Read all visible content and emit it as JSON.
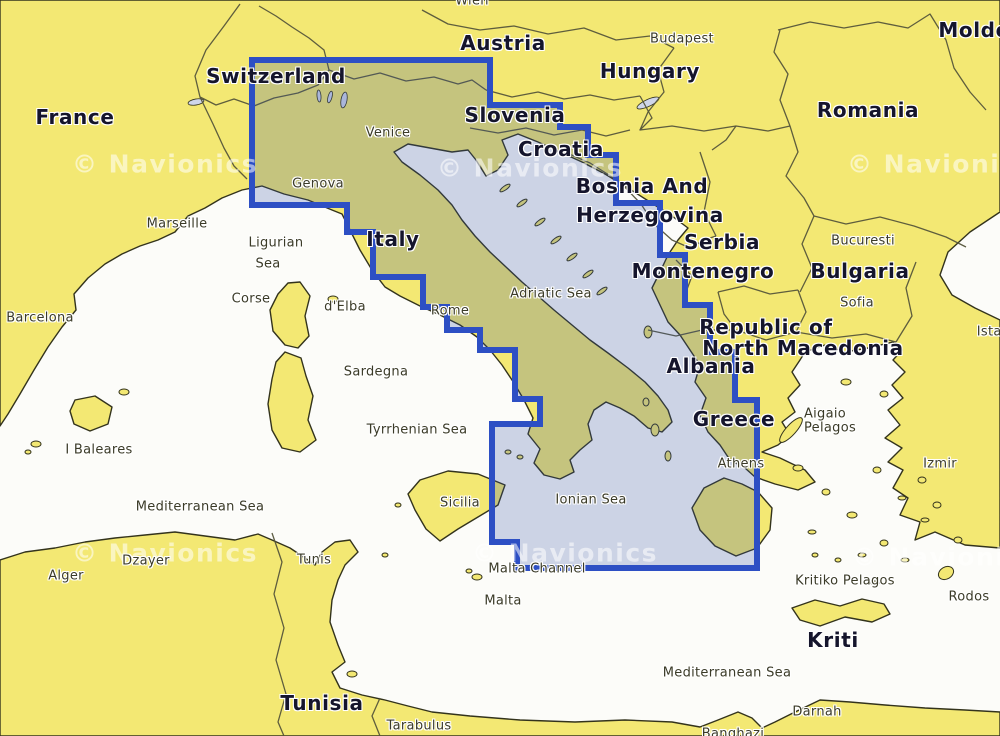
{
  "map": {
    "colors": {
      "sea": "#fcfcf9",
      "land": "#f3e873",
      "coastline": "#33331c",
      "border_line": "#55553a",
      "lake": "#cfd6ea",
      "coverage_fill": "rgba(47,76,164,0.23)",
      "coverage_border": "#2d4fc4",
      "label_large": "#15152c",
      "label_small": "#3b3b28",
      "watermark": "rgba(255,255,255,0.55)"
    },
    "coverage": {
      "points": [
        [
          252,
          60
        ],
        [
          490,
          60
        ],
        [
          490,
          105
        ],
        [
          560,
          105
        ],
        [
          560,
          127
        ],
        [
          588,
          127
        ],
        [
          588,
          155
        ],
        [
          616,
          155
        ],
        [
          616,
          203
        ],
        [
          660,
          203
        ],
        [
          660,
          255
        ],
        [
          685,
          255
        ],
        [
          685,
          305
        ],
        [
          710,
          305
        ],
        [
          710,
          352
        ],
        [
          735,
          352
        ],
        [
          735,
          400
        ],
        [
          757,
          400
        ],
        [
          757,
          568
        ],
        [
          517,
          568
        ],
        [
          517,
          542
        ],
        [
          492,
          542
        ],
        [
          492,
          424
        ],
        [
          540,
          424
        ],
        [
          540,
          399
        ],
        [
          515,
          399
        ],
        [
          515,
          350
        ],
        [
          480,
          350
        ],
        [
          480,
          330
        ],
        [
          447,
          330
        ],
        [
          447,
          307
        ],
        [
          423,
          307
        ],
        [
          423,
          277
        ],
        [
          373,
          277
        ],
        [
          373,
          232
        ],
        [
          347,
          232
        ],
        [
          347,
          205
        ],
        [
          252,
          205
        ]
      ]
    },
    "watermark": {
      "text": "© Navionics",
      "positions": [
        [
          165,
          164
        ],
        [
          530,
          168
        ],
        [
          940,
          164
        ],
        [
          165,
          553
        ],
        [
          565,
          553
        ],
        [
          945,
          557
        ]
      ]
    },
    "labels": {
      "large": [
        {
          "text": "France",
          "x": 75,
          "y": 117
        },
        {
          "text": "Switzerland",
          "x": 276,
          "y": 76
        },
        {
          "text": "Austria",
          "x": 503,
          "y": 43
        },
        {
          "text": "Hungary",
          "x": 650,
          "y": 71
        },
        {
          "text": "Moldova",
          "x": 988,
          "y": 30
        },
        {
          "text": "Romania",
          "x": 868,
          "y": 110
        },
        {
          "text": "Slovenia",
          "x": 515,
          "y": 115
        },
        {
          "text": "Croatia",
          "x": 561,
          "y": 149
        },
        {
          "text": "Bosnia And",
          "x": 642,
          "y": 186
        },
        {
          "text": "Herzegovina",
          "x": 650,
          "y": 215
        },
        {
          "text": "Serbia",
          "x": 722,
          "y": 242
        },
        {
          "text": "Montenegro",
          "x": 703,
          "y": 271
        },
        {
          "text": "Bulgaria",
          "x": 860,
          "y": 271
        },
        {
          "text": "Republic of",
          "x": 766,
          "y": 327
        },
        {
          "text": "North Macedonia",
          "x": 803,
          "y": 348
        },
        {
          "text": "Albania",
          "x": 711,
          "y": 366
        },
        {
          "text": "Italy",
          "x": 393,
          "y": 239
        },
        {
          "text": "Greece",
          "x": 734,
          "y": 419
        },
        {
          "text": "Kriti",
          "x": 833,
          "y": 640
        },
        {
          "text": "Tunisia",
          "x": 322,
          "y": 703
        }
      ],
      "small": [
        {
          "text": "Wien",
          "x": 472,
          "y": 1
        },
        {
          "text": "Budapest",
          "x": 682,
          "y": 39
        },
        {
          "text": "Venice",
          "x": 388,
          "y": 133
        },
        {
          "text": "Genova",
          "x": 318,
          "y": 184
        },
        {
          "text": "Marseille",
          "x": 177,
          "y": 224
        },
        {
          "text": "Bucuresti",
          "x": 863,
          "y": 241
        },
        {
          "text": "Ligurian",
          "x": 276,
          "y": 243
        },
        {
          "text": "Sea",
          "x": 268,
          "y": 264
        },
        {
          "text": "Corse",
          "x": 251,
          "y": 299
        },
        {
          "text": "d'Elba",
          "x": 345,
          "y": 307
        },
        {
          "text": "Rome",
          "x": 450,
          "y": 311
        },
        {
          "text": "Adriatic Sea",
          "x": 551,
          "y": 294
        },
        {
          "text": "Sofia",
          "x": 857,
          "y": 303
        },
        {
          "text": "Istanbul",
          "x": 1004,
          "y": 332
        },
        {
          "text": "Barcelona",
          "x": 40,
          "y": 318
        },
        {
          "text": "Sardegna",
          "x": 376,
          "y": 372
        },
        {
          "text": "Aigaio",
          "x": 825,
          "y": 414
        },
        {
          "text": "Pelagos",
          "x": 830,
          "y": 428
        },
        {
          "text": "I Baleares",
          "x": 99,
          "y": 450
        },
        {
          "text": "Tyrrhenian Sea",
          "x": 417,
          "y": 430
        },
        {
          "text": "Izmir",
          "x": 940,
          "y": 464
        },
        {
          "text": "Athens",
          "x": 741,
          "y": 464
        },
        {
          "text": "Mediterranean Sea",
          "x": 200,
          "y": 507
        },
        {
          "text": "Sicilia",
          "x": 460,
          "y": 503
        },
        {
          "text": "Ionian Sea",
          "x": 591,
          "y": 500
        },
        {
          "text": "Alger",
          "x": 66,
          "y": 576
        },
        {
          "text": "Dzayer",
          "x": 146,
          "y": 561
        },
        {
          "text": "Tunis",
          "x": 314,
          "y": 560
        },
        {
          "text": "Malta Channel",
          "x": 537,
          "y": 569
        },
        {
          "text": "Kritiko Pelagos",
          "x": 845,
          "y": 581
        },
        {
          "text": "Malta",
          "x": 503,
          "y": 601
        },
        {
          "text": "Rodos",
          "x": 969,
          "y": 597
        },
        {
          "text": "Mediterranean Sea",
          "x": 727,
          "y": 673
        },
        {
          "text": "Darnah",
          "x": 817,
          "y": 712
        },
        {
          "text": "Tarabulus",
          "x": 419,
          "y": 726
        },
        {
          "text": "Banghazi",
          "x": 733,
          "y": 734
        }
      ]
    }
  }
}
